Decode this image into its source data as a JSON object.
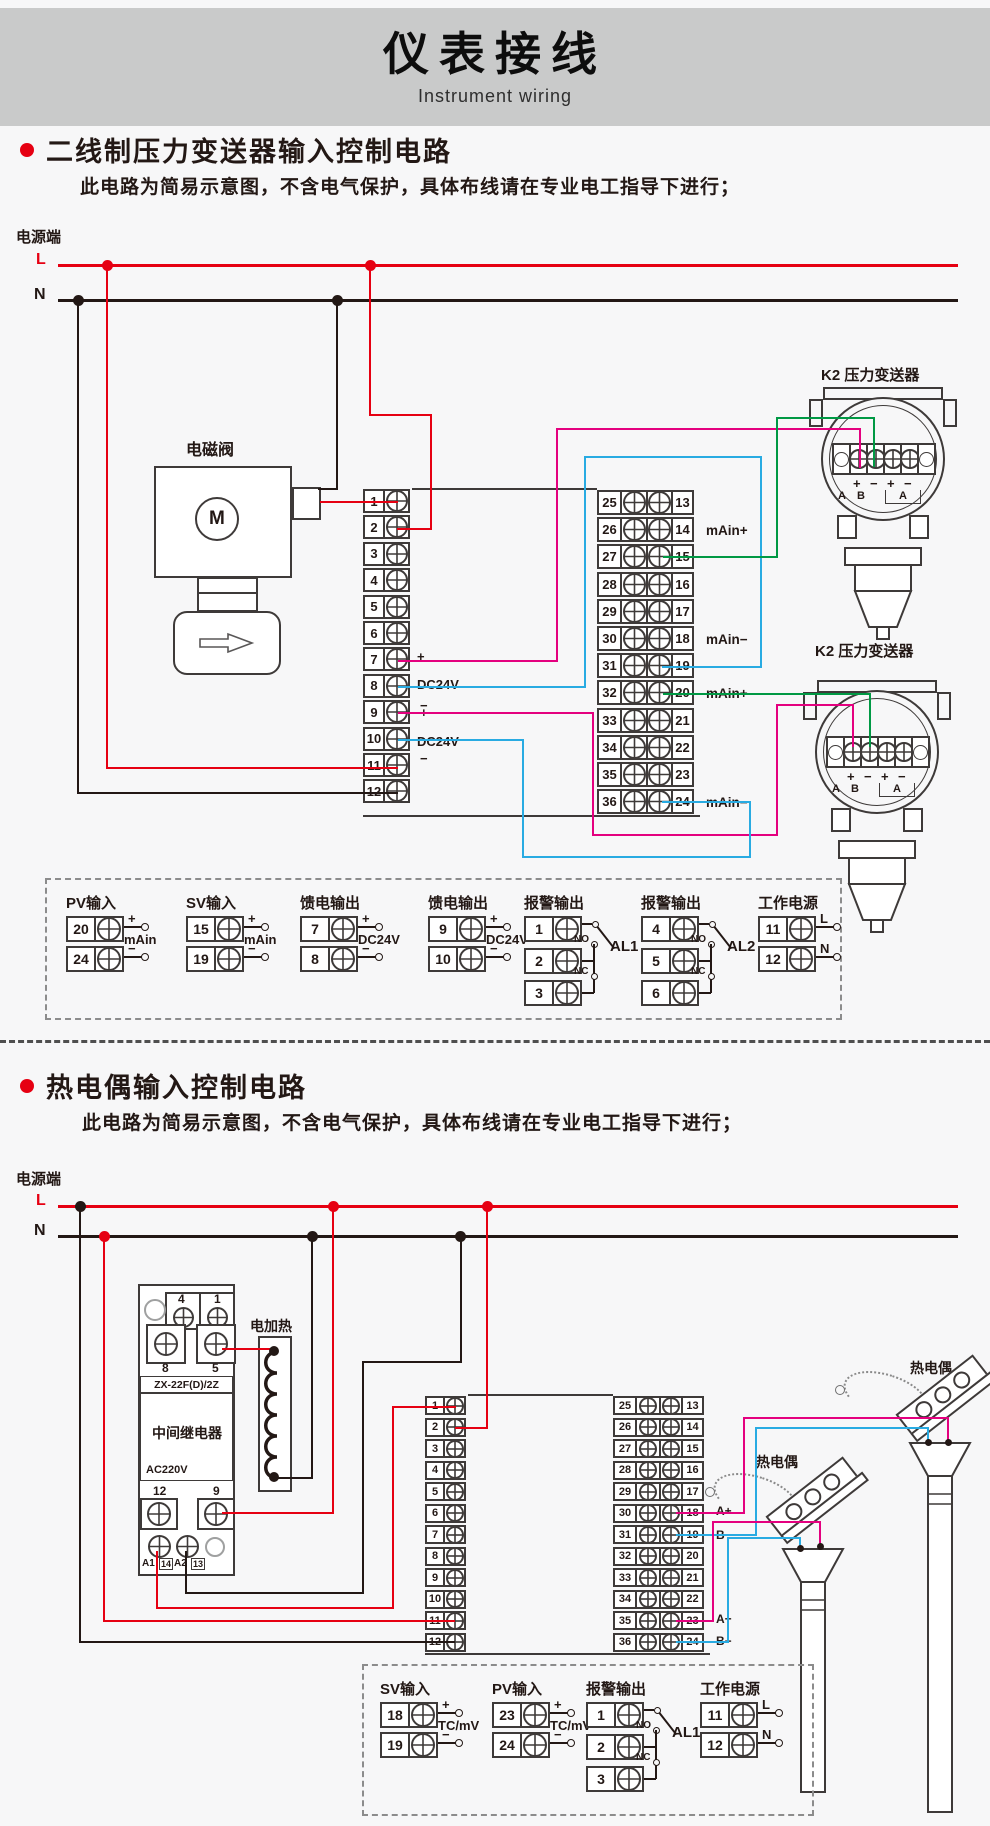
{
  "header": {
    "title": "仪表接线",
    "subtitle": "Instrument wiring"
  },
  "colors": {
    "band": "#c9caca",
    "red": "#e60012",
    "black": "#231815",
    "magenta": "#e4007f",
    "blue": "#29abe2",
    "green": "#009944",
    "outline": "#3e3a39",
    "bullet": "#e60012",
    "gray": "#9fa0a0"
  },
  "power": {
    "terminal": "电源端",
    "live": "L",
    "neutral": "N"
  },
  "sections": [
    {
      "title": "二线制压力变送器输入控制电路",
      "note": "此电路为简易示意图，不含电气保护，具体布线请在专业电工指导下进行；"
    },
    {
      "title": "热电偶输入控制电路",
      "note": "此电路为简易示意图，不含电气保护，具体布线请在专业电工指导下进行；"
    }
  ],
  "circuit1": {
    "solenoid": {
      "label": "电磁阀",
      "motor": "M"
    },
    "left_terminals": [
      "1",
      "2",
      "3",
      "4",
      "5",
      "6",
      "7",
      "8",
      "9",
      "10",
      "11",
      "12"
    ],
    "left_side_labels": [
      "+",
      "DC24V",
      "−",
      "+",
      "DC24V",
      "−"
    ],
    "right_terminals_outer": [
      "25",
      "26",
      "27",
      "28",
      "29",
      "30",
      "31",
      "32",
      "33",
      "34",
      "35",
      "36"
    ],
    "right_terminals_inner": [
      "13",
      "14",
      "15",
      "16",
      "17",
      "18",
      "19",
      "20",
      "21",
      "22",
      "23",
      "24"
    ],
    "right_side_labels": [
      "mAin+",
      "mAin−",
      "mAin+",
      "mAin−"
    ],
    "transmitter": {
      "label": "K2 压力变送器",
      "signs": [
        "+",
        "−",
        "+",
        "−"
      ],
      "subs": [
        "A",
        "B",
        "A"
      ]
    },
    "legend_groups": [
      {
        "type": "io",
        "title": "PV输入",
        "rows": [
          [
            "20",
            "+"
          ],
          [
            "24",
            "−"
          ]
        ],
        "mid": "mAin"
      },
      {
        "type": "io",
        "title": "SV输入",
        "rows": [
          [
            "15",
            "+"
          ],
          [
            "19",
            "−"
          ]
        ],
        "mid": "mAin"
      },
      {
        "type": "io",
        "title": "馈电输出",
        "rows": [
          [
            "7",
            "+"
          ],
          [
            "8",
            "−"
          ]
        ],
        "mid": "DC24V"
      },
      {
        "type": "io",
        "title": "馈电输出",
        "rows": [
          [
            "9",
            "+"
          ],
          [
            "10",
            "−"
          ]
        ],
        "mid": "DC24V"
      },
      {
        "type": "alarm",
        "title": "报警输出",
        "rows": [
          "1",
          "2",
          "3"
        ],
        "no_label": "NO",
        "nc_label": "NC",
        "al_label": "AL1"
      },
      {
        "type": "alarm",
        "title": "报警输出",
        "rows": [
          "4",
          "5",
          "6"
        ],
        "no_label": "NO",
        "nc_label": "NC",
        "al_label": "AL2"
      },
      {
        "type": "io",
        "title": "工作电源",
        "rows": [
          [
            "11",
            "L"
          ],
          [
            "12",
            "N"
          ]
        ],
        "mid": ""
      }
    ]
  },
  "circuit2": {
    "relay": {
      "top_labels": [
        "4",
        "1"
      ],
      "mid_labels": [
        "8",
        "5"
      ],
      "model": "ZX-22F(D)/2Z",
      "name": "中间继电器",
      "voltage": "AC220V",
      "bottom_labels": [
        "12",
        "9"
      ],
      "coil_labels": [
        "A1",
        "14",
        "A2",
        "13"
      ]
    },
    "heater_label": "电加热",
    "thermocouple_label": "热电偶",
    "left_terminals": [
      "1",
      "2",
      "3",
      "4",
      "5",
      "6",
      "7",
      "8",
      "9",
      "10",
      "11",
      "12"
    ],
    "right_terminals_outer": [
      "25",
      "26",
      "27",
      "28",
      "29",
      "30",
      "31",
      "32",
      "33",
      "34",
      "35",
      "36"
    ],
    "right_terminals_inner": [
      "13",
      "14",
      "15",
      "16",
      "17",
      "18",
      "19",
      "20",
      "21",
      "22",
      "23",
      "24"
    ],
    "right_side_labels": [
      "A+",
      "B−",
      "A+",
      "B−"
    ],
    "legend_groups": [
      {
        "type": "io",
        "title": "SV输入",
        "rows": [
          [
            "18",
            "+"
          ],
          [
            "19",
            "−"
          ]
        ],
        "mid": "TC/mV"
      },
      {
        "type": "io",
        "title": "PV输入",
        "rows": [
          [
            "23",
            "+"
          ],
          [
            "24",
            "−"
          ]
        ],
        "mid": "TC/mV"
      },
      {
        "type": "alarm",
        "title": "报警输出",
        "rows": [
          "1",
          "2",
          "3"
        ],
        "no_label": "NO",
        "nc_label": "NC",
        "al_label": "AL1"
      },
      {
        "type": "io",
        "title": "工作电源",
        "rows": [
          [
            "11",
            "L"
          ],
          [
            "12",
            "N"
          ]
        ],
        "mid": ""
      }
    ]
  }
}
